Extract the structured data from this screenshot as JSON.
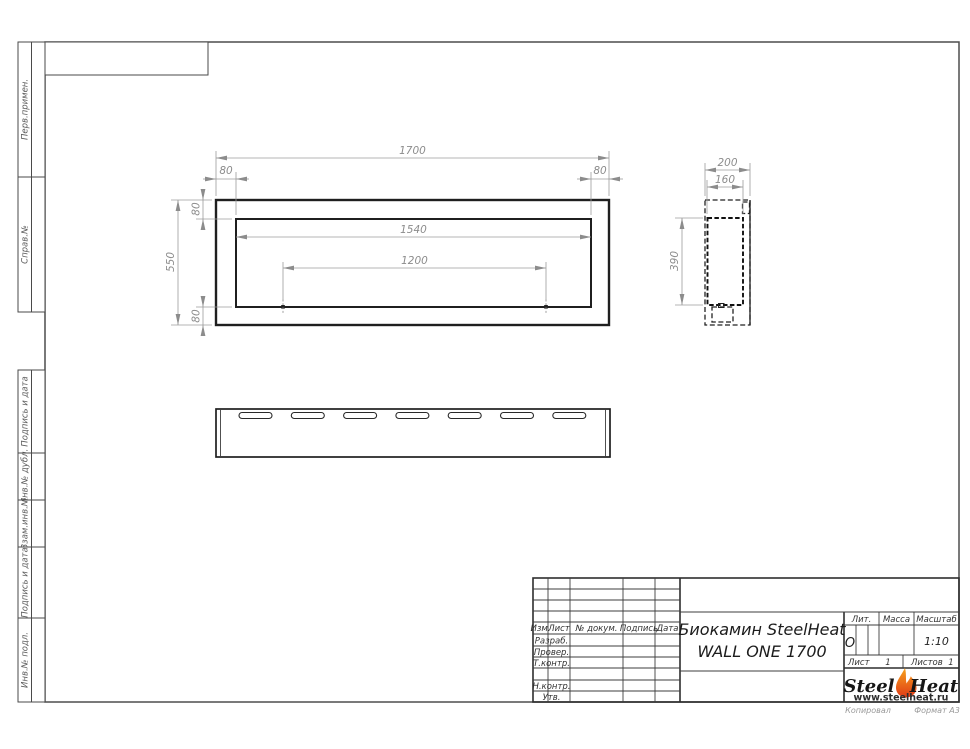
{
  "page": {
    "footer_left": "Копировал",
    "footer_right": "Формат А3"
  },
  "stamps_left": [
    {
      "label": "Перв.примен."
    },
    {
      "label": "Справ.№"
    },
    {
      "label": "Подпись и дата"
    },
    {
      "label": "Инв.№ дубл."
    },
    {
      "label": "Взам.инв.№"
    },
    {
      "label": "Подпись и дата"
    },
    {
      "label": "Инв.№ подл."
    }
  ],
  "dimensions": {
    "front": {
      "overall_width": "1700",
      "inset_left": "80",
      "inset_right": "80",
      "opening_width": "1540",
      "burner_spacing": "1200",
      "overall_height": "550",
      "inset_top": "80",
      "inset_bottom": "80"
    },
    "side": {
      "depth": "200",
      "inner_depth": "160",
      "inner_height": "390"
    }
  },
  "title_block": {
    "header_cols": [
      "Изм.",
      "Лист",
      "№ докум.",
      "Подпись",
      "Дата"
    ],
    "row_labels": [
      "Разраб.",
      "Провер.",
      "Т.контр.",
      "Н.контр.",
      "Утв."
    ],
    "doc_title_line1": "Биокамин SteelHeat",
    "doc_title_line2": "WALL ONE 1700",
    "lit_label": "Лит.",
    "lit_value": "О",
    "mass_label": "Масса",
    "scale_label": "Масштаб",
    "scale_value": "1:10",
    "sheet_label": "Лист",
    "sheet_value": "1",
    "sheets_label": "Листов",
    "sheets_value": "1",
    "logo": {
      "steel": "Steel",
      "heat": "Heat",
      "url": "www.steelheat.ru"
    }
  },
  "colors": {
    "line": "#1f1f1f",
    "dim": "#8c8c8c",
    "flame_top": "#f6a21c",
    "flame_bottom": "#e03a17"
  }
}
